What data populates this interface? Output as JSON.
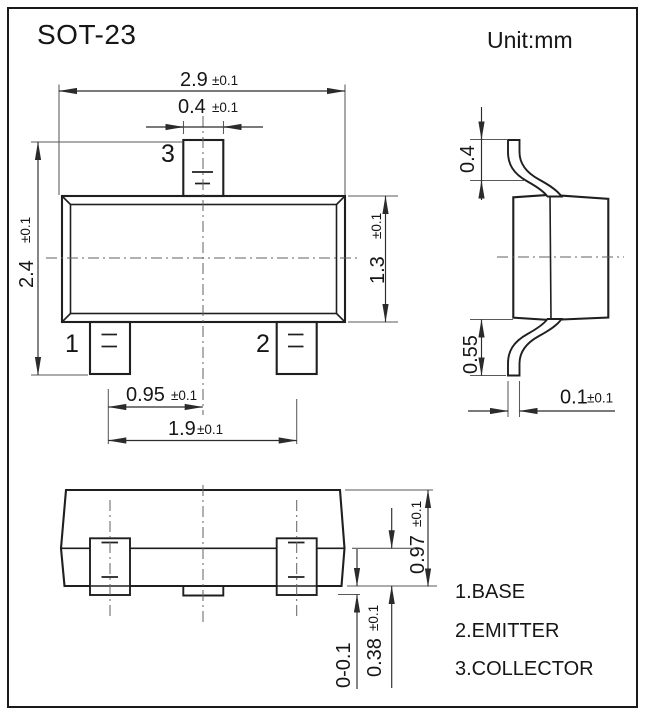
{
  "title": "SOT-23",
  "unit_label": "Unit:mm",
  "colors": {
    "ink": "#1f1f1f",
    "background": "#ffffff"
  },
  "pins": {
    "p1": "1",
    "p2": "2",
    "p3": "3"
  },
  "legend": {
    "items": [
      "1.BASE",
      "2.EMITTER",
      "3.COLLECTOR"
    ]
  },
  "dims": {
    "body_width": {
      "value": "2.9",
      "tol": "±0.1"
    },
    "pin3_width": {
      "value": "0.4",
      "tol": "±0.1"
    },
    "overall_height": {
      "value": "2.4",
      "tol": "±0.1"
    },
    "body_height": {
      "value": "1.3",
      "tol": "±0.1"
    },
    "pin_pitch": {
      "value": "0.95",
      "tol": "±0.1"
    },
    "pin_span": {
      "value": "1.9",
      "tol": "±0.1"
    },
    "lead_top_height": {
      "value": "0.4",
      "tol": ""
    },
    "lead_bottom_height": {
      "value": "0.55",
      "tol": ""
    },
    "lead_thickness": {
      "value": "0.1",
      "tol": "±0.1"
    },
    "profile_height": {
      "value": "0.97",
      "tol": "±0.1"
    },
    "standoff": {
      "value": "0-0.1",
      "tol": ""
    },
    "base_height": {
      "value": "0.38",
      "tol": "±0.1"
    }
  }
}
